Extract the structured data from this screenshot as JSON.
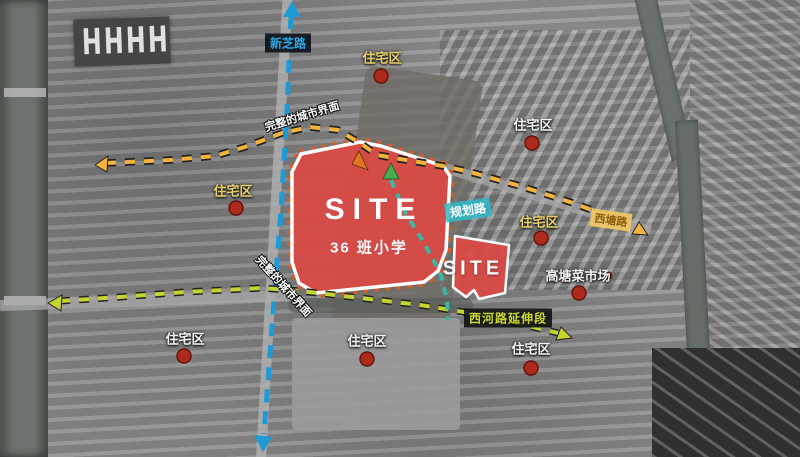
{
  "sites": {
    "main": {
      "name": "SITE",
      "description": "36 班小学"
    },
    "secondary": {
      "name": "SITE"
    }
  },
  "roads": {
    "xinzhi": "新芝路",
    "planned": "规划路",
    "xitang": "西塘路",
    "xihe_extension": "西河路延伸段"
  },
  "labels": {
    "residential": "住宅区",
    "market": "高塘菜市场"
  },
  "annotations": {
    "urban_interface_north": "完整的城市界面",
    "urban_interface_west": "完整的城市界面"
  },
  "colors": {
    "site_red": "#d84a45",
    "axis_blue": "#1e9ad6",
    "interface_yellow": "#f3b33c",
    "extension_green": "#c6d431",
    "planned_teal": "#38b9a8",
    "marker_red": "#ad2a1c"
  }
}
